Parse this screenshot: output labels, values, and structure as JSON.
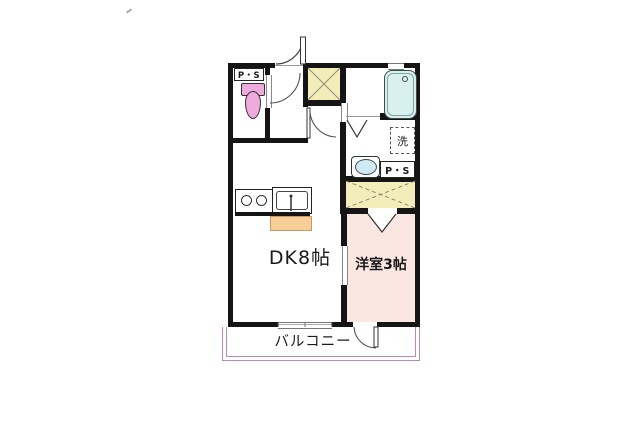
{
  "floorplan": {
    "labels": {
      "dk_room": "DK8帖",
      "western_room": "洋室3帖",
      "balcony": "バルコニー",
      "pipe_space_toilet": "P・S",
      "pipe_space_washroom": "P・S",
      "washing_machine": "洗"
    },
    "colors": {
      "wall": "#151515",
      "shaft_yellow": "#f3edba",
      "western_room_pink": "#fae7e1",
      "toilet_pink": "#efaade",
      "bathtub_blue": "#d8f0ee",
      "sink_blue": "#cfeaf3",
      "counter_orange": "#f7cf96",
      "balcony_purple": "#b88ab8"
    }
  }
}
